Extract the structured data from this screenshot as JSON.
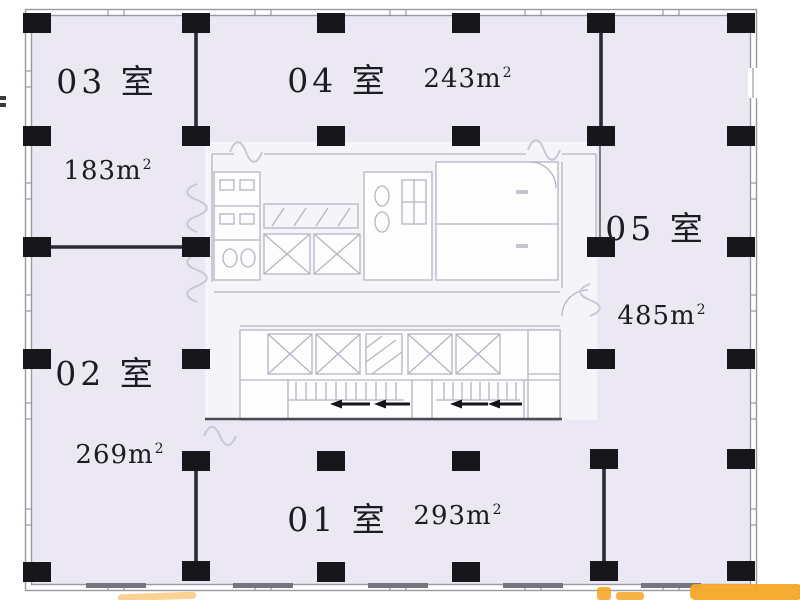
{
  "floorplan": {
    "rooms": [
      {
        "id": "01",
        "name": "01 室",
        "area_value": "293m",
        "area_sup": "2"
      },
      {
        "id": "02",
        "name": "02 室",
        "area_value": "269m",
        "area_sup": "2"
      },
      {
        "id": "03",
        "name": "03 室",
        "area_value": "183m",
        "area_sup": "2"
      },
      {
        "id": "04",
        "name": "04 室",
        "area_value": "243m",
        "area_sup": "2"
      },
      {
        "id": "05",
        "name": "05 室",
        "area_value": "485m",
        "area_sup": "2"
      }
    ],
    "colors": {
      "floor_fill": "#ebe8f3",
      "core_fill": "#f5f4f9",
      "wall_line": "#9a98a2",
      "column": "#17171b",
      "partition": "#2a2a31",
      "core_line": "#b6b4c2",
      "text_color": "#1c1c20",
      "watermark": "#f5a728"
    }
  }
}
